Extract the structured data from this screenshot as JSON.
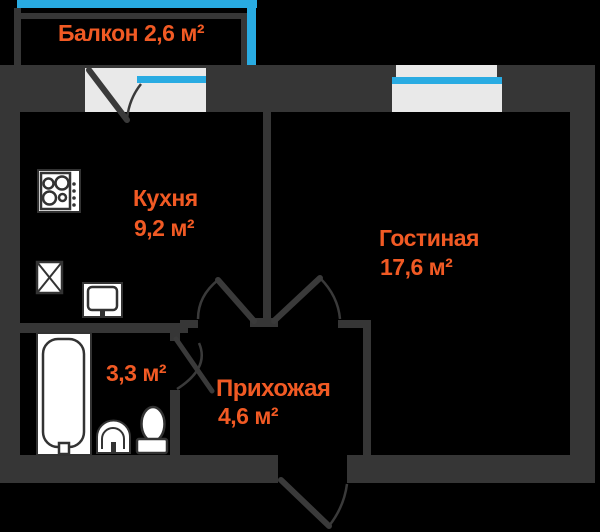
{
  "floorplan": {
    "title": "Однокомнатная квартира — план",
    "rooms": {
      "balcony": {
        "label": "Балкон 2,6 м²"
      },
      "kitchen": {
        "name": "Кухня",
        "area": "9,2 м²"
      },
      "living_room": {
        "name": "Гостиная",
        "area": "17,6 м²"
      },
      "bathroom": {
        "area": "3,3 м²"
      },
      "hallway": {
        "name": "Прихожая",
        "area": "4,6 м²"
      }
    },
    "colors": {
      "background": "#000000",
      "wall": "#363636",
      "window_accent_cyan": "#29abe2",
      "window_fill": "#e9e9e9",
      "fixture_fill": "#ffffff",
      "label_orange": "#f15a24"
    }
  }
}
